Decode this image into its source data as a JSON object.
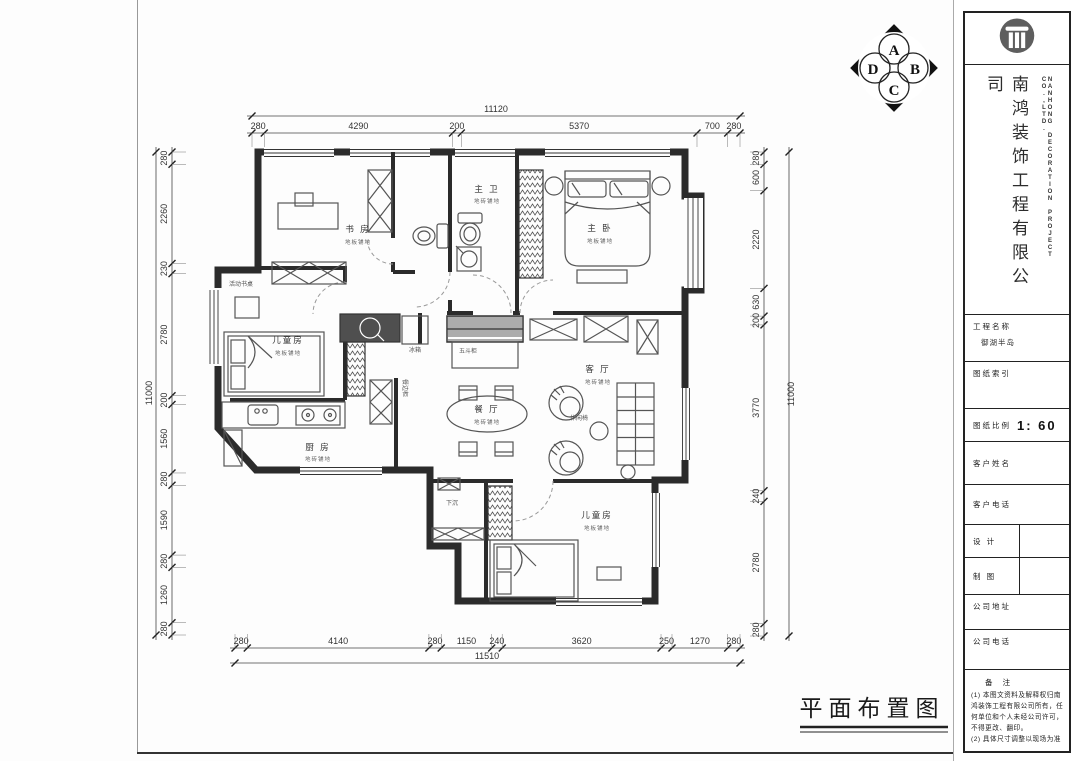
{
  "caption": "平面布置图",
  "compass": {
    "a": "A",
    "b": "B",
    "c": "C",
    "d": "D"
  },
  "title_block": {
    "company_cn": "南鸿装饰工程有限公司",
    "company_en": "NANHONG DECORATION PROJECT CO.,LTD.",
    "logo_icon": "column-logo",
    "fields": {
      "project_label": "工程名称",
      "project_value": "御湖半岛",
      "index_label": "图纸索引",
      "scale_label": "图纸比例",
      "scale_value": "1: 60",
      "client_name_label": "客户姓名",
      "client_phone_label": "客户电话",
      "design_label": "设 计",
      "draft_label": "制 图",
      "address_label": "公司地址",
      "company_phone_label": "公司电话"
    },
    "notes": {
      "title": "备 注",
      "note1": "(1) 本图文资料及解释权归南鸿装饰工程有限公司所有，任何单位和个人未经公司许可，不得更改、翻印。",
      "note2": "(2) 具体尺寸调整以现场为准"
    }
  },
  "rooms": [
    {
      "name": "书 房",
      "floor": "地板铺地"
    },
    {
      "name": "主 卫",
      "floor": "地砖铺地"
    },
    {
      "name": "主 卧",
      "floor": "地板铺地"
    },
    {
      "name": "儿童房",
      "floor": "地板铺地"
    },
    {
      "name": "厨 房",
      "floor": "地砖铺地"
    },
    {
      "name": "餐 厅",
      "floor": "地砖铺地"
    },
    {
      "name": "客 厅",
      "floor": "地砖铺地"
    },
    {
      "name": "儿童房",
      "floor": "地板铺地"
    }
  ],
  "small_labels": {
    "desk": "活动书桌",
    "fridge": "冰箱",
    "side_cabinet": "餐边柜",
    "chest": "五斗柜",
    "leisure_chair": "休闲椅",
    "sunken": "下沉"
  },
  "dimensions": {
    "top": {
      "overall": "11120",
      "segments": [
        "280",
        "4290",
        "200",
        "5370",
        "700",
        "280"
      ]
    },
    "bottom": {
      "overall": "11510",
      "segments": [
        "280",
        "4140",
        "280",
        "1150",
        "240",
        "3620",
        "250",
        "1270",
        "280"
      ]
    },
    "left": {
      "overall": "11000",
      "segments": [
        "280",
        "2260",
        "230",
        "2780",
        "200",
        "1560",
        "280",
        "1590",
        "280",
        "1260",
        "280"
      ]
    },
    "right": {
      "overall": "11000",
      "segments": [
        "280",
        "600",
        "2220",
        "630",
        "200",
        "3770",
        "240",
        "2780",
        "280"
      ]
    }
  }
}
